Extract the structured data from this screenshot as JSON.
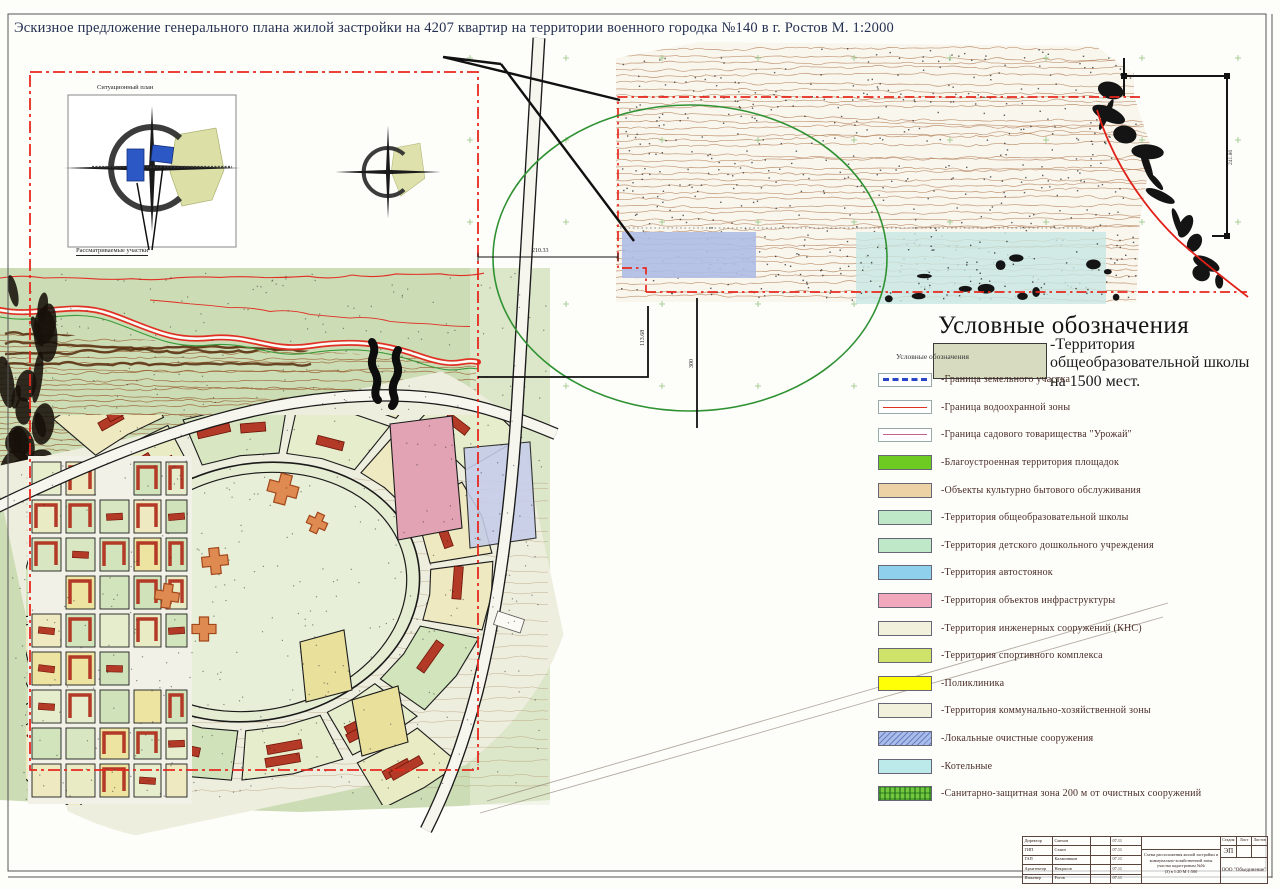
{
  "page_title": "Эскизное предложение генерального плана жилой застройки на 4207 квартир на территории военного городка №140 в г. Ростов   М. 1:2000",
  "situational_plan": {
    "title": "Ситуационный план",
    "caption": "Рассматриваемые участки"
  },
  "dimensions": {
    "d_top": "210.33",
    "d_left": "113.68",
    "d_mid": "300",
    "d_right": "241.86"
  },
  "legend": {
    "header": "Условные обозначения",
    "note": "Условные обозначения",
    "school_item": {
      "line1": "-Территория",
      "line2": "общеобразовательной школы",
      "line3": "на 1500 мест.",
      "color": "#d7dcc0"
    },
    "items": [
      {
        "label": "-Граница земельного участка",
        "color": "#2a46c8"
      },
      {
        "label": "-Граница водоохранной зоны",
        "color": "#e03024"
      },
      {
        "label": "-Граница садового товарищества \"Урожай\"",
        "color": "#c2608e"
      },
      {
        "label": "-Благоустроенная территория площадок",
        "color": "#6ecb21"
      },
      {
        "label": "-Объекты культурно бытового обслуживания",
        "color": "#ecd2a4"
      },
      {
        "label": "-Территория  общеобразовательной школы",
        "color": "#bfe8c8"
      },
      {
        "label": "-Территория детского дошкольного учреждения",
        "color": "#bfe8c8"
      },
      {
        "label": "-Территория автостоянок",
        "color": "#8fd0ec"
      },
      {
        "label": "-Территория объектов инфраструктуры",
        "color": "#f2a8bc"
      },
      {
        "label": "-Территория инженерных сооружений (КНС)",
        "color": "#f2f2dc"
      },
      {
        "label": "-Территория спортивного комплекса",
        "color": "#cfe26a"
      },
      {
        "label": "-Поликлиника",
        "color": "#ffff06"
      },
      {
        "label": "-Территория коммунально-хозяйственной зоны",
        "color": "#f2f2dc"
      },
      {
        "label": "-Локальные очистные сооружения",
        "color": "#a9bdea"
      },
      {
        "label": "-Котельные",
        "color": "#bce9e9"
      },
      {
        "label": "-Санитарно-защитная зона 200 м от очистных сооружений",
        "color": "#74c83e"
      }
    ]
  },
  "title_block": {
    "rows": [
      {
        "role": "Директор",
        "name": "Смехов",
        "date": "07.11"
      },
      {
        "role": "ГИП",
        "name": "Стаин",
        "date": "07.11"
      },
      {
        "role": "ГАП",
        "name": "Калашников",
        "date": "07.11"
      },
      {
        "role": "Архитектор",
        "name": "Некрасов",
        "date": "07.11"
      },
      {
        "role": "Инженер",
        "name": "Рогов",
        "date": "07.11"
      }
    ],
    "stage_label": "Стадия",
    "sheet_label": "Лист",
    "sheets_label": "Листов",
    "stage_value": "ЭП",
    "subject_lines": [
      "Схема расположения жилой застройки и",
      "коммунально-хозяйственной зоны",
      "участка кадастровым №№",
      "(3) в 1:20   М 1:500"
    ],
    "company": "ООО \"Объединение\""
  },
  "colors": {
    "boundary_red": "#e8281e",
    "survey_ellipse_green": "#2f9232",
    "contour_brown": "#b5835c",
    "map_green": "#ccdcb4",
    "building_red": "#b43526",
    "title_ink": "#243050"
  }
}
